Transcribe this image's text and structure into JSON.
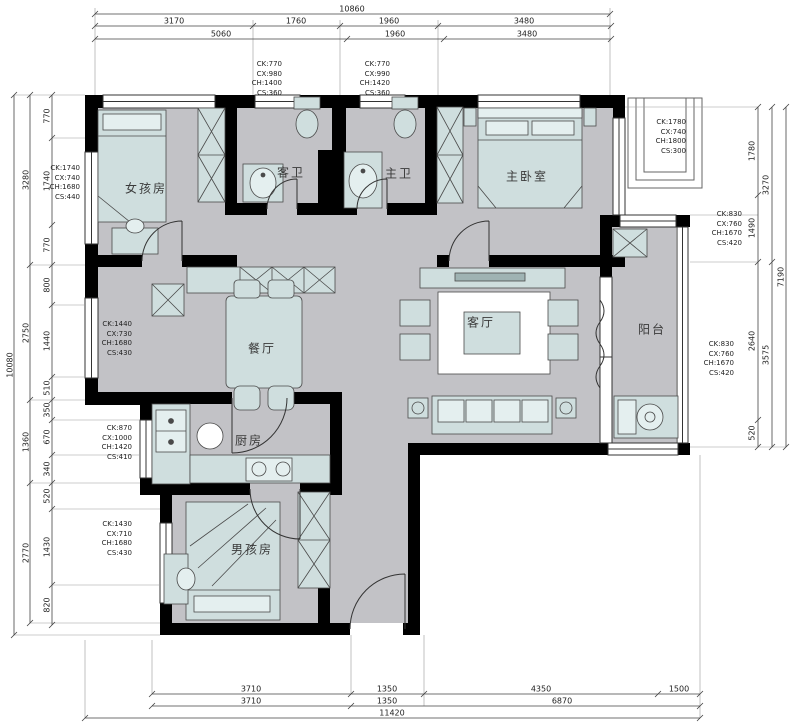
{
  "drawing_type": "apartment-floor-plan",
  "colors": {
    "wall": "#000000",
    "floor": "#c2c2c6",
    "furniture": "#cfdede",
    "dim_line": "#555555",
    "text": "#222222"
  },
  "rooms": {
    "girl_room": "女孩房",
    "guest_bath": "客卫",
    "master_bath": "主卫",
    "master_bedroom": "主卧室",
    "dining": "餐厅",
    "living": "客厅",
    "balcony": "阳台",
    "kitchen": "厨房",
    "boy_room": "男孩房"
  },
  "window_specs": {
    "guest_bath": [
      "CK:770",
      "CX:980",
      "CH:1400",
      "CS:360"
    ],
    "master_bath": [
      "CK:770",
      "CX:990",
      "CH:1420",
      "CS:360"
    ],
    "girl_room": [
      "CK:1740",
      "CX:740",
      "CH:1680",
      "CS:440"
    ],
    "master_bedroom": [
      "CK:1780",
      "CX:740",
      "CH:1800",
      "CS:300"
    ],
    "balcony_upper": [
      "CK:830",
      "CX:760",
      "CH:1670",
      "CS:420"
    ],
    "balcony_lower": [
      "CK:830",
      "CX:760",
      "CH:1670",
      "CS:420"
    ],
    "dining": [
      "CK:1440",
      "CX:730",
      "CH:1680",
      "CS:430"
    ],
    "kitchen": [
      "CK:870",
      "CX:1000",
      "CH:1420",
      "CS:410"
    ],
    "boy_room": [
      "CK:1430",
      "CX:710",
      "CH:1680",
      "CS:430"
    ]
  },
  "dimensions": {
    "top": {
      "overall": "10860",
      "row1": [
        "3170",
        "1760",
        "1960",
        "3480"
      ],
      "row2": [
        "5060",
        "1960",
        "3480"
      ]
    },
    "bottom": {
      "row1": [
        "3710",
        "1350",
        "4350",
        "1500"
      ],
      "row2": [
        "3710",
        "1350",
        "6870"
      ],
      "overall": "11420"
    },
    "left": {
      "overall": "10080",
      "groups": [
        "3280",
        "2750",
        "1360",
        "2770"
      ],
      "segments": [
        "770",
        "1740",
        "770",
        "800",
        "1440",
        "510",
        "350",
        "670",
        "340",
        "520",
        "1430",
        "820"
      ]
    },
    "right": {
      "segments": [
        "1780",
        "1490",
        "2640",
        "520"
      ],
      "groups": [
        "3270",
        "3575"
      ],
      "overall": "7190"
    }
  }
}
